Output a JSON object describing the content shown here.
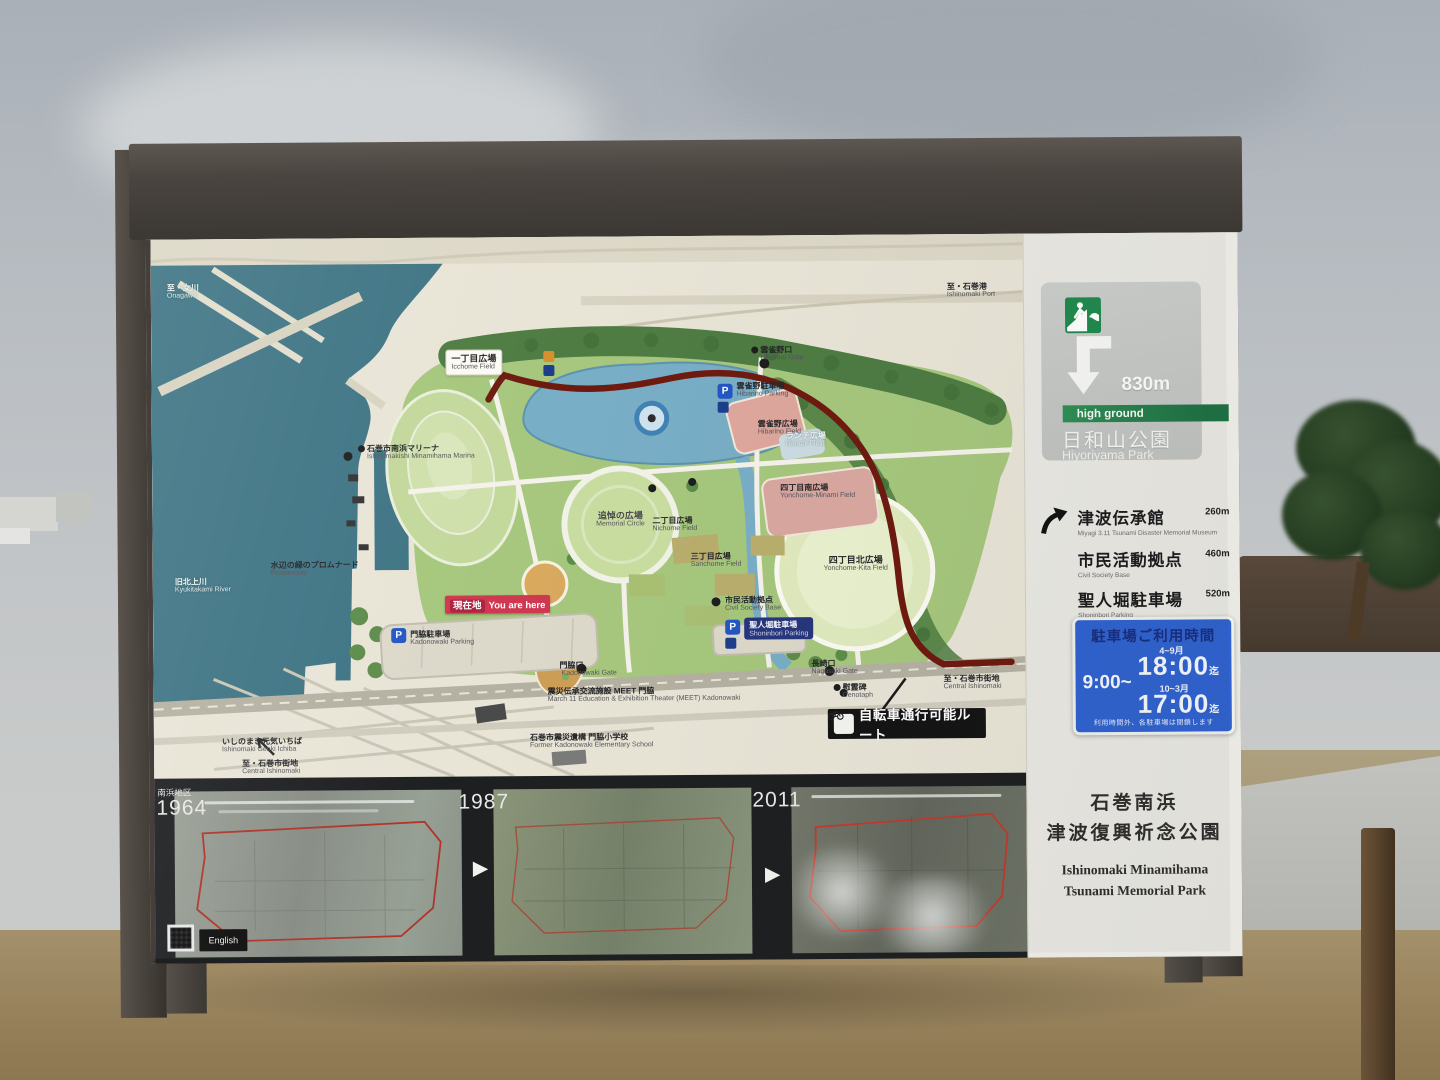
{
  "colors": {
    "water_teal": "#3e7484",
    "park_green": "#a6c77d",
    "forest_green": "#4e7c42",
    "route_red": "#6e1a0f",
    "you_are_here_red": "#cf3850",
    "parking_blue": "#2456c4",
    "hours_sign_blue": "#2f62cf",
    "evacuation_green": "#1f8a4c",
    "frame_dark": "#4a4540"
  },
  "sign": {
    "evacuation": {
      "distance": "830m",
      "bar_label": "high ground",
      "dest_jp": "日和山公園",
      "dest_en": "Hiyoriyama Park"
    },
    "directions": [
      {
        "jp": "津波伝承館",
        "en": "Miyagi 3.11 Tsunami Disaster Memorial Museum",
        "dist": "260m"
      },
      {
        "jp": "市民活動拠点",
        "en": "Civil Society Base",
        "dist": "460m"
      },
      {
        "jp": "聖人堀駐車場",
        "en": "Shoninbori Parking",
        "dist": "520m"
      }
    ],
    "parking": {
      "title": "駐車場ご利用時間",
      "open": "9:00~",
      "seasons": [
        {
          "label": "4~9月",
          "time": "18:00",
          "until": "迄"
        },
        {
          "label": "10~3月",
          "time": "17:00",
          "until": "迄"
        }
      ],
      "note": "利用時間外、各駐車場は閉鎖します"
    },
    "title": {
      "jp1": "石巻南浜",
      "jp2": "津波復興祈念公園",
      "en1": "Ishinomaki Minamihama",
      "en2": "Tsunami Memorial Park"
    }
  },
  "map": {
    "labels": {
      "onagawa": {
        "jp": "至・女川",
        "en": "Onagawa"
      },
      "kyukitakami": {
        "jp": "旧北上川",
        "en": "Kyukitakami River"
      },
      "marina": {
        "jp": "石巻市南浜マリーナ",
        "en": "Ishinomakishi Minamihama Marina"
      },
      "promenade": {
        "jp": "水辺の緑のプロムナード",
        "en": "Promenade"
      },
      "genki_ichiba": {
        "jp": "いしのまき元気いちば",
        "en": "Ishinomaki Genki Ichiba"
      },
      "central_sw": {
        "jp": "至・石巻市街地",
        "en": "Central Ishinomaki"
      },
      "central_e": {
        "jp": "至・石巻市街地",
        "en": "Central Ishinomaki"
      },
      "port": {
        "jp": "至・石巻港",
        "en": "Ishinomaki Port"
      },
      "icchome": {
        "jp": "一丁目広場",
        "en": "Icchome Field"
      },
      "nichome": {
        "jp": "二丁目広場",
        "en": "Nichome Field"
      },
      "sanchome": {
        "jp": "三丁目広場",
        "en": "Sanchome Field"
      },
      "yonchome_minami": {
        "jp": "四丁目南広場",
        "en": "Yonchome-Minami Field"
      },
      "yonchome_kita": {
        "jp": "四丁目北広場",
        "en": "Yonchome-Kita Field"
      },
      "hibarino_gate": {
        "jp": "雲雀野口",
        "en": "Hibarino Gate"
      },
      "hibarino_parking": {
        "jp": "雲雀野駐車場",
        "en": "Hibarino Parking"
      },
      "hibarino_field": {
        "jp": "雲雀野広場",
        "en": "Hibarino Field"
      },
      "ranchi": {
        "jp": "ランチ広場",
        "en": "Ranchi Field"
      },
      "memorial_circle": {
        "jp": "追悼の広場",
        "en": "Memorial Circle"
      },
      "civil_base": {
        "jp": "市民活動拠点",
        "en": "Civil Society Base"
      },
      "kadonowaki_parking": {
        "jp": "門脇駐車場",
        "en": "Kadonowaki Parking"
      },
      "shoninbori_parking": {
        "jp": "聖人堀駐車場",
        "en": "Shoninbori Parking"
      },
      "kadonowaki_gate": {
        "jp": "門脇口",
        "en": "Kadonowaki Gate"
      },
      "nagasaki_gate": {
        "jp": "長崎口",
        "en": "Nagasaki Gate"
      },
      "cenotaph": {
        "jp": "慰霊碑",
        "en": "Cenotaph"
      },
      "meet": {
        "jp": "震災伝承交流施設 MEET 門脇",
        "en": "March 11 Education & Exhibition Theater (MEET) Kadonowaki"
      },
      "school": {
        "jp": "石巻市震災遺構 門脇小学校",
        "en": "Former Kadonowaki Elementary School"
      }
    },
    "you_are_here": {
      "jp": "現在地",
      "en": "You are here"
    },
    "bike_route_label": "自転車通行可能ルート",
    "parking_letter": "P"
  },
  "photos": {
    "district": "南浜地区",
    "years": [
      "1964",
      "1987",
      "2011"
    ],
    "english_label": "English",
    "next_glyph": "▶"
  }
}
